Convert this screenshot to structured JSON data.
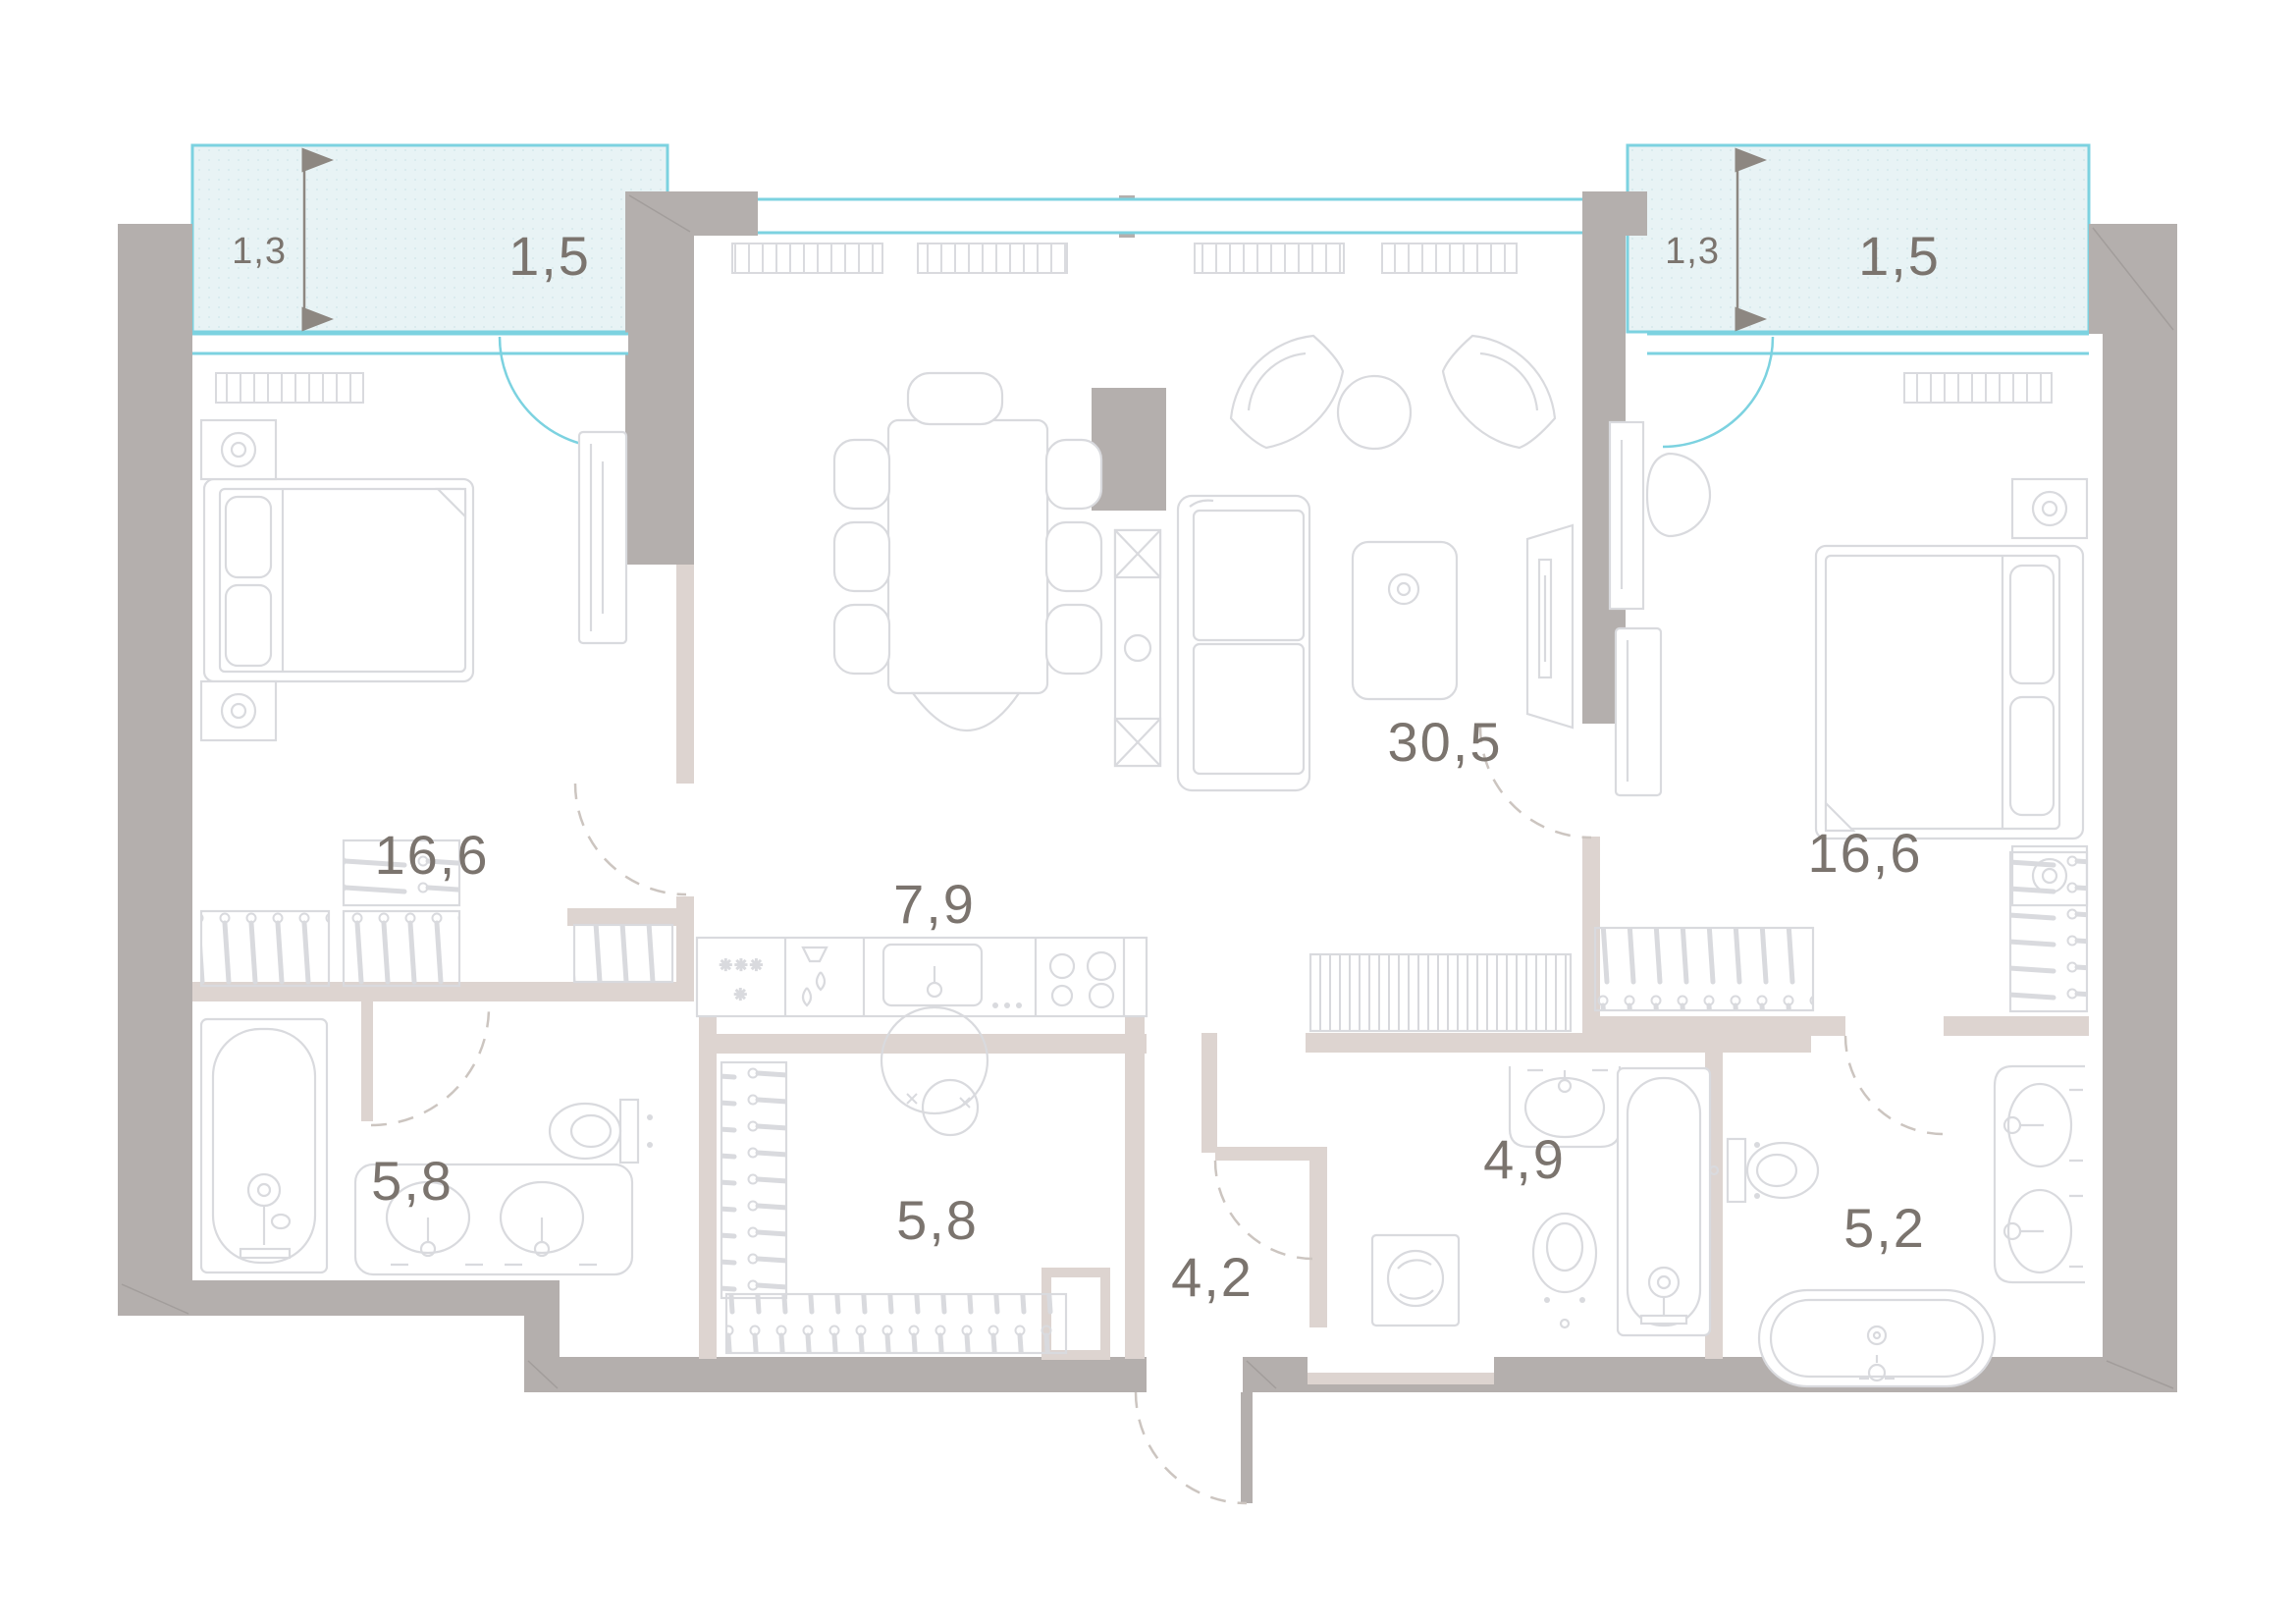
{
  "plan": {
    "title": "apartment-floor-plan",
    "units": "square-meters",
    "colors": {
      "exterior_wall": "#b4afad",
      "interior_wall": "#ddd4d0",
      "window_accent": "#7cd2e0",
      "balcony_fill": "#e8f3f5",
      "furniture_line": "#d9dade",
      "label_text": "#7b746e",
      "door_swing_dash": "#ccc5c0"
    },
    "balconies": [
      {
        "side": "left",
        "area_label": "1,5",
        "depth_label": "1,3"
      },
      {
        "side": "right",
        "area_label": "1,5",
        "depth_label": "1,3"
      }
    ],
    "rooms": [
      {
        "name": "bedroom-left",
        "area_label": "16,6"
      },
      {
        "name": "kitchen-dining",
        "area_label": "7,9"
      },
      {
        "name": "living-room",
        "area_label": "30,5"
      },
      {
        "name": "bedroom-right",
        "area_label": "16,6"
      },
      {
        "name": "bathroom-left",
        "area_label": "5,8"
      },
      {
        "name": "dressing-room",
        "area_label": "5,8"
      },
      {
        "name": "entrance-hall",
        "area_label": "4,2"
      },
      {
        "name": "bathroom-guest",
        "area_label": "4,9"
      },
      {
        "name": "bathroom-master",
        "area_label": "5,2"
      }
    ],
    "icons": {
      "fridge_snowflakes": "✳✳✳",
      "fridge_snowflake_single": "✳"
    }
  }
}
